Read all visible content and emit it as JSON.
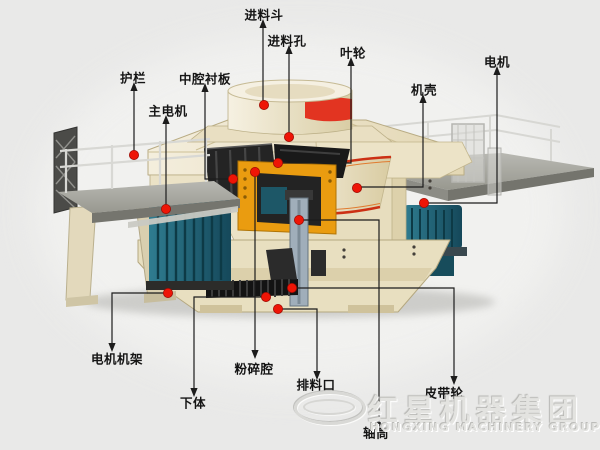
{
  "diagram": {
    "machine_name": "立式冲击破碎机结构图",
    "callouts": [
      {
        "id": "feed-hopper",
        "text": "进料斗",
        "label": [
          264,
          14
        ],
        "dot": [
          264,
          105
        ],
        "path": [
          [
            263,
            103
          ],
          [
            263,
            27
          ]
        ],
        "dir": "up"
      },
      {
        "id": "feed-inlet",
        "text": "进料孔",
        "label": [
          287,
          40
        ],
        "dot": [
          289,
          137
        ],
        "path": [
          [
            289,
            135
          ],
          [
            289,
            53
          ]
        ],
        "dir": "up"
      },
      {
        "id": "impeller",
        "text": "叶轮",
        "label": [
          353,
          52
        ],
        "dot": [
          278,
          163
        ],
        "path": [
          [
            278,
            163
          ],
          [
            351,
            163
          ],
          [
            351,
            65
          ]
        ],
        "dir": "up"
      },
      {
        "id": "casing",
        "text": "机壳",
        "label": [
          424,
          89
        ],
        "dot": [
          357,
          188
        ],
        "path": [
          [
            359,
            187
          ],
          [
            423,
            187
          ],
          [
            423,
            102
          ]
        ],
        "dir": "up"
      },
      {
        "id": "motor",
        "text": "电机",
        "label": [
          497,
          61
        ],
        "dot": [
          424,
          203
        ],
        "path": [
          [
            426,
            203
          ],
          [
            497,
            203
          ],
          [
            497,
            74
          ]
        ],
        "dir": "up"
      },
      {
        "id": "guard-rail",
        "text": "护栏",
        "label": [
          133,
          77
        ],
        "dot": [
          134,
          155
        ],
        "path": [
          [
            134,
            152
          ],
          [
            134,
            90
          ]
        ],
        "dir": "up"
      },
      {
        "id": "middle-cavity-liner",
        "text": "中腔衬板",
        "label": [
          205,
          78
        ],
        "dot": [
          233,
          179
        ],
        "path": [
          [
            231,
            179
          ],
          [
            205,
            179
          ],
          [
            205,
            91
          ]
        ],
        "dir": "up"
      },
      {
        "id": "main-motor",
        "text": "主电机",
        "label": [
          168,
          110
        ],
        "dot": [
          166,
          209
        ],
        "path": [
          [
            166,
            206
          ],
          [
            166,
            123
          ]
        ],
        "dir": "up"
      },
      {
        "id": "motor-frame",
        "text": "电机机架",
        "label": [
          117,
          358
        ],
        "dot": [
          168,
          293
        ],
        "path": [
          [
            166,
            293
          ],
          [
            112,
            293
          ],
          [
            112,
            344
          ]
        ],
        "dir": "down"
      },
      {
        "id": "lower-body",
        "text": "下体",
        "label": [
          193,
          402
        ],
        "dot": [
          266,
          297
        ],
        "path": [
          [
            264,
            297
          ],
          [
            194,
            297
          ],
          [
            194,
            389
          ]
        ],
        "dir": "down"
      },
      {
        "id": "crushing-chamber",
        "text": "粉碎腔",
        "label": [
          254,
          368
        ],
        "dot": [
          255,
          172
        ],
        "path": [
          [
            255,
            174
          ],
          [
            255,
            351
          ]
        ],
        "dir": "down"
      },
      {
        "id": "discharge-port",
        "text": "排料口",
        "label": [
          316,
          384
        ],
        "dot": [
          278,
          309
        ],
        "path": [
          [
            280,
            309
          ],
          [
            317,
            309
          ],
          [
            317,
            372
          ]
        ],
        "dir": "down"
      },
      {
        "id": "shaft-cylinder",
        "text": "轴筒",
        "label": [
          376,
          432
        ],
        "dot": [
          299,
          220
        ],
        "path": [
          [
            301,
            220
          ],
          [
            379,
            220
          ],
          [
            379,
            420
          ]
        ],
        "dir": "down"
      },
      {
        "id": "belt-pulley",
        "text": "皮带轮",
        "label": [
          444,
          392
        ],
        "dot": [
          292,
          288
        ],
        "path": [
          [
            294,
            288
          ],
          [
            454,
            288
          ],
          [
            454,
            377
          ]
        ],
        "dir": "down"
      }
    ]
  },
  "watermark": {
    "chinese": "红星机器集团",
    "english": "HONGXING MACHINERY GROUP"
  },
  "colors": {
    "line": "#1c1c1c",
    "dot_red": "#ee1506",
    "band_red": "#e23421",
    "rim_red": "#cc3014",
    "machine_cream": "#ebe2c6",
    "motor_teal": "#1c5a6b",
    "part_orange": "#ea9c10",
    "background": "#e9e9e8"
  }
}
